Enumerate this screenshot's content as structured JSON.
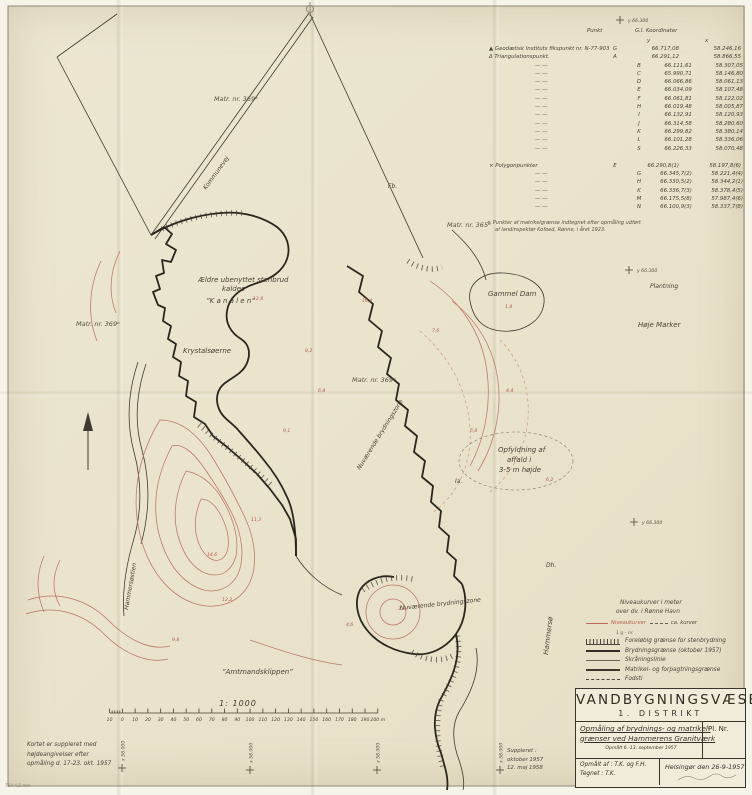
{
  "paper": {
    "corner_note": "754 4,5 mm"
  },
  "coord_table": {
    "header": {
      "punkt": "Punkt",
      "coords": "G.I. Koordinater",
      "y": "y",
      "x": "x"
    },
    "fixpoint_label": "Geodætisk Instituts fikspunkt nr. N-77-903",
    "triangulation_label": "Triangulationspunkt.",
    "ditto": "—  —",
    "rows": [
      {
        "p": "G",
        "y": "66.717,08",
        "x": "58.246,16"
      },
      {
        "p": "A",
        "y": "66.291,12",
        "x": "58.866,55"
      },
      {
        "p": "B",
        "y": "66.111,61",
        "x": "58.307,05"
      },
      {
        "p": "C",
        "y": "65.990,71",
        "x": "58.146,80"
      },
      {
        "p": "D",
        "y": "66.066,86",
        "x": "58.061,13"
      },
      {
        "p": "E",
        "y": "66.034,09",
        "x": "58.107,48"
      },
      {
        "p": "F",
        "y": "66.061,81",
        "x": "58.122,02"
      },
      {
        "p": "H",
        "y": "66.019,48",
        "x": "58.005,87"
      },
      {
        "p": "I",
        "y": "66.132,91",
        "x": "58.120,93"
      },
      {
        "p": "J",
        "y": "66.314,58",
        "x": "58.280,60"
      },
      {
        "p": "K",
        "y": "66.299,82",
        "x": "58.380,14"
      },
      {
        "p": "L",
        "y": "66.101,28",
        "x": "58.336,06"
      },
      {
        "p": "S",
        "y": "66.226,33",
        "x": "58.070,48"
      }
    ],
    "polygon_label": "Polygonpunkter",
    "polygon_rows": [
      {
        "p": "E",
        "y": "66.290,8(1)",
        "x": "58.197,8(6)"
      },
      {
        "p": "G",
        "y": "66.345,7(2)",
        "x": "58.221,4(4)"
      },
      {
        "p": "H",
        "y": "66.330,5(2)",
        "x": "58.344,2(1)"
      },
      {
        "p": "K",
        "y": "66.336,7(3)",
        "x": "58.378,4(5)"
      },
      {
        "p": "M",
        "y": "66.175,5(8)",
        "x": "57.987,4(6)"
      },
      {
        "p": "N",
        "y": "66.100,9(3)",
        "x": "58.337,7(8)"
      }
    ],
    "footnote_1": "× Punkter af matrikelgrænse indtegnet efter opmåling udført",
    "footnote_2": "af landinspektør Kofoed, Rønne, i året 1923."
  },
  "legend": {
    "heading_1": "Niveaukurver i meter",
    "heading_2": "over dv. i Rønne Havn",
    "contour_solid": "Niveaukurver",
    "contour_dashed": "ca. kurver",
    "parcel_note": "1 g - nr.",
    "items": [
      "Foreløbig grænse for stenbrydning",
      "Brydningsgrænse (oktober 1957)",
      "Skråningslinie",
      "Matrikel- og forpagtningsgrænse",
      "Fodsti"
    ]
  },
  "title_block": {
    "agency": "VANDBYGNINGSVÆSENET",
    "district": "1. DISTRIKT",
    "title_1": "Opmåling af brydnings- og matrikel-",
    "title_2": "grænser ved Hammerens Granitværk",
    "subtitle": "Opmålt 6.-13. september 1957",
    "plate_label": "Pl. Nr.",
    "surveyed_by": "Opmålt af :  T.K. og F.H.",
    "drawn_by": "Tegnet  :  T.K.",
    "place_date": "Helsingør den 26-9-1957"
  },
  "scale": {
    "title": "1: 1000",
    "unit_labels": [
      "10",
      "0",
      "10",
      "20",
      "30",
      "40",
      "50",
      "60",
      "70",
      "80",
      "90",
      "100",
      "110",
      "120",
      "130",
      "140",
      "150",
      "160",
      "170",
      "180",
      "190",
      "200 m"
    ]
  },
  "notes": {
    "bottom_left": [
      "Kortet er suppleret med",
      "højdeangivelser efter",
      "opmåling d. 17-23. okt. 1957"
    ],
    "suppleret": [
      "Suppleret :",
      "oktober 1957",
      "12. maj 1958"
    ]
  },
  "map": {
    "labels": [
      {
        "t": "Matr. nr. 369ᵃ",
        "x": 214,
        "y": 101,
        "s": "matr"
      },
      {
        "t": "Matr. nr. 365ᵈ",
        "x": 447,
        "y": 227,
        "s": "matr"
      },
      {
        "t": "Matr. nr. 369ᵇ",
        "x": 76,
        "y": 326,
        "s": "matr"
      },
      {
        "t": "Matr. nr. 369ᵈ",
        "x": 352,
        "y": 382,
        "s": "matr"
      },
      {
        "t": "Ældre ubenyttet stenbrud",
        "x": 198,
        "y": 282,
        "s": "place"
      },
      {
        "t": "kaldes",
        "x": 222,
        "y": 291,
        "s": "place"
      },
      {
        "t": "”K a n a l e n”",
        "x": 206,
        "y": 303,
        "s": "place"
      },
      {
        "t": "Krystalsøerne",
        "x": 183,
        "y": 353,
        "s": "place"
      },
      {
        "t": "Gammel Dam",
        "x": 488,
        "y": 296,
        "s": "place"
      },
      {
        "t": "Plantning",
        "x": 650,
        "y": 288,
        "s": "small"
      },
      {
        "t": "Høje Marker",
        "x": 638,
        "y": 327,
        "s": "place"
      },
      {
        "t": "Opfyldning af",
        "x": 498,
        "y": 452,
        "s": "place"
      },
      {
        "t": "affald i",
        "x": 507,
        "y": 462,
        "s": "place"
      },
      {
        "t": "3-5 m højde",
        "x": 499,
        "y": 472,
        "s": "place"
      },
      {
        "t": "Nuværende brydningszone",
        "x": 360,
        "y": 470,
        "r": -58,
        "s": "small"
      },
      {
        "t": "Nuværende brydningszone",
        "x": 400,
        "y": 610,
        "r": -6,
        "s": "small"
      },
      {
        "t": "”Amtmandsklippen”",
        "x": 222,
        "y": 674,
        "s": "place"
      },
      {
        "t": "Kommunevej",
        "x": 206,
        "y": 190,
        "r": -54,
        "s": "small"
      },
      {
        "t": "Hammersøstien",
        "x": 128,
        "y": 610,
        "r": -80,
        "s": "small"
      },
      {
        "t": "Hammersø",
        "x": 548,
        "y": 655,
        "r": -83,
        "s": "place"
      },
      {
        "t": "Fb.",
        "x": 388,
        "y": 188,
        "s": "small"
      },
      {
        "t": "Ia.",
        "x": 455,
        "y": 483,
        "s": "small"
      },
      {
        "t": "Dh.",
        "x": 546,
        "y": 567,
        "s": "small"
      }
    ],
    "spot_heights": [
      {
        "x": 253,
        "y": 300,
        "v": "12,8"
      },
      {
        "x": 305,
        "y": 352,
        "v": "8,2"
      },
      {
        "x": 318,
        "y": 392,
        "v": "6,4"
      },
      {
        "x": 283,
        "y": 432,
        "v": "9,1"
      },
      {
        "x": 251,
        "y": 521,
        "v": "11,3"
      },
      {
        "x": 207,
        "y": 556,
        "v": "14,6"
      },
      {
        "x": 222,
        "y": 601,
        "v": "12,2"
      },
      {
        "x": 172,
        "y": 641,
        "v": "9,8"
      },
      {
        "x": 346,
        "y": 626,
        "v": "4,6"
      },
      {
        "x": 398,
        "y": 610,
        "v": "3,2"
      },
      {
        "x": 470,
        "y": 432,
        "v": "5,8"
      },
      {
        "x": 506,
        "y": 392,
        "v": "4,4"
      },
      {
        "x": 546,
        "y": 481,
        "v": "6,2"
      },
      {
        "x": 432,
        "y": 332,
        "v": "7,6"
      },
      {
        "x": 505,
        "y": 308,
        "v": "1,8"
      },
      {
        "x": 362,
        "y": 302,
        "v": "10,4"
      }
    ],
    "grid_crosses": [
      {
        "x": 620,
        "y": 20,
        "l": "y 66.300",
        "r": 0
      },
      {
        "x": 629,
        "y": 270,
        "l": "y 66.300",
        "r": 0
      },
      {
        "x": 634,
        "y": 522,
        "l": "y 66.300",
        "r": 0
      },
      {
        "x": 122,
        "y": 768,
        "l": "x 58.000",
        "r": -90
      },
      {
        "x": 250,
        "y": 770,
        "l": "x 58.000",
        "r": -90
      },
      {
        "x": 377,
        "y": 770,
        "l": "x 58.000",
        "r": -90
      },
      {
        "x": 500,
        "y": 770,
        "l": "x 58.000",
        "r": -90
      }
    ]
  }
}
